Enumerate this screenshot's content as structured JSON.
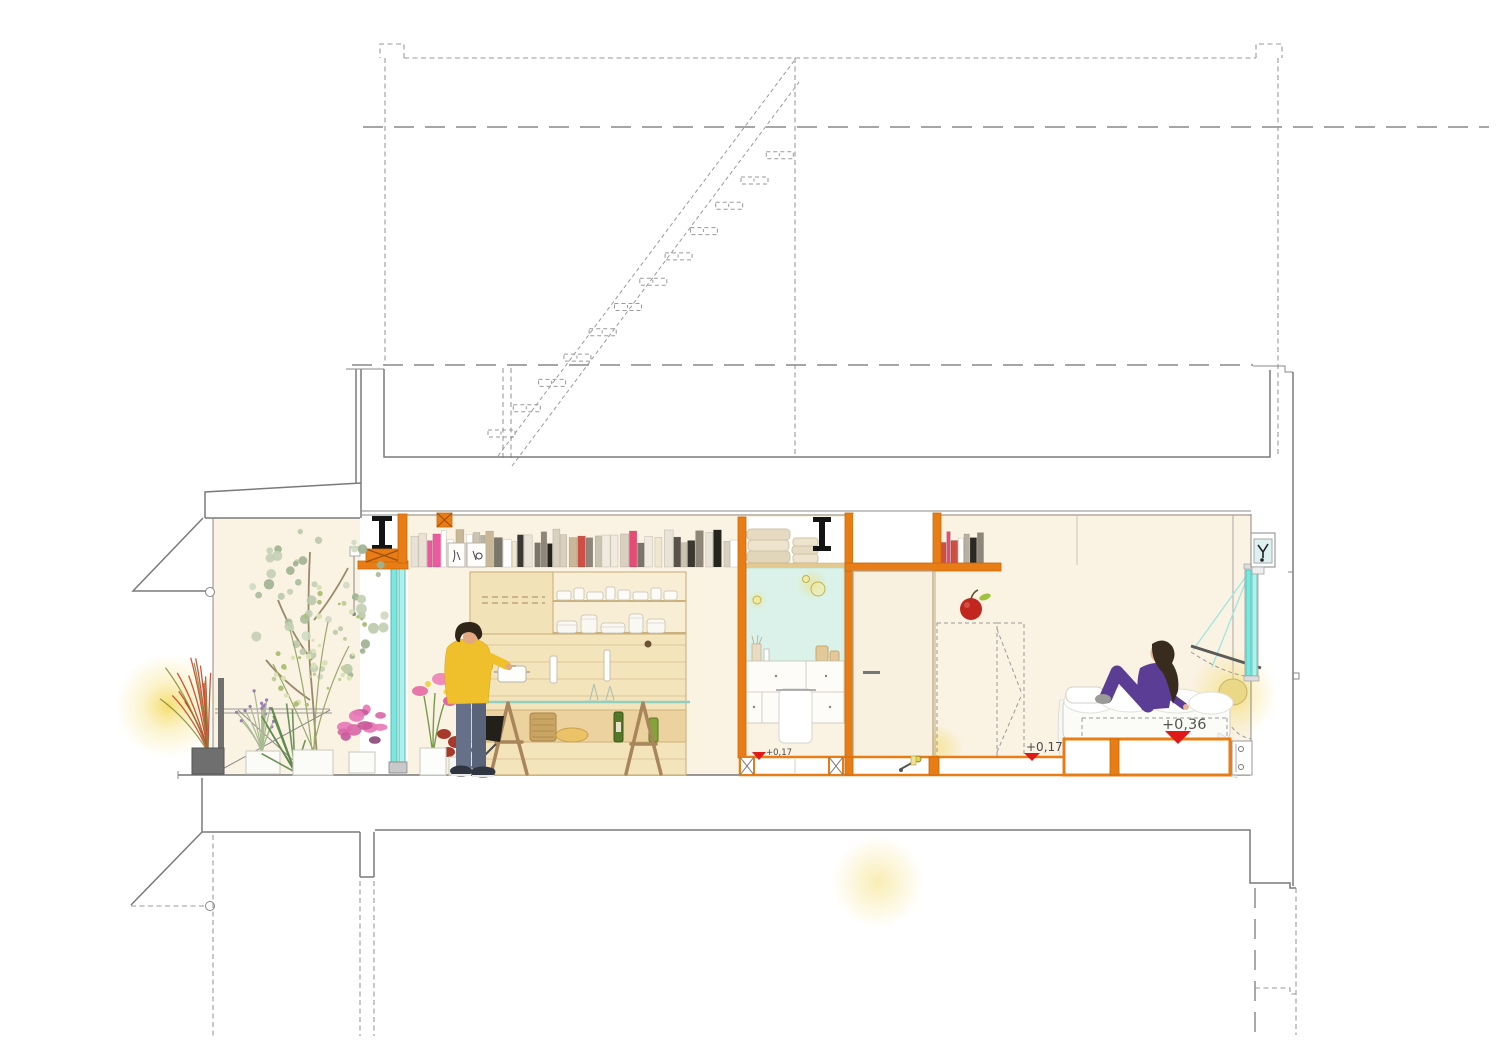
{
  "drawing": {
    "type": "architectural-section",
    "level_markers": [
      {
        "label": "+0,17"
      },
      {
        "label": "+0,17"
      },
      {
        "label": "+0,36"
      }
    ],
    "colors": {
      "interior_cream": "#faf2e3",
      "structure_orange": "#e87c15",
      "glazing_cyan": "#7ce7e2",
      "mirror_blue": "#daf2ea",
      "glow_yellow": "#f5d94a",
      "marker_red": "#e01818",
      "line_gray": "#8a8a8a",
      "steel_black": "#141414",
      "wood_tan": "#f4e4bc"
    },
    "figures": [
      {
        "name": "person-standing-kitchen",
        "outfit": "yellow sweater, grey jeans"
      },
      {
        "name": "person-sitting-bed",
        "outfit": "purple loungewear"
      }
    ],
    "rooms": [
      {
        "name": "balcony-garden"
      },
      {
        "name": "kitchen"
      },
      {
        "name": "bathroom"
      },
      {
        "name": "hallway-door"
      },
      {
        "name": "bedroom"
      }
    ],
    "elements": [
      "dashed-upper-floor-outline",
      "dashed-staircase",
      "bookshelf-row",
      "steel-i-beam",
      "glazed-door",
      "wardrobe-dashed",
      "pendant-lamp",
      "bed-platform",
      "floor-framing",
      "apple-decor",
      "device-box"
    ]
  }
}
